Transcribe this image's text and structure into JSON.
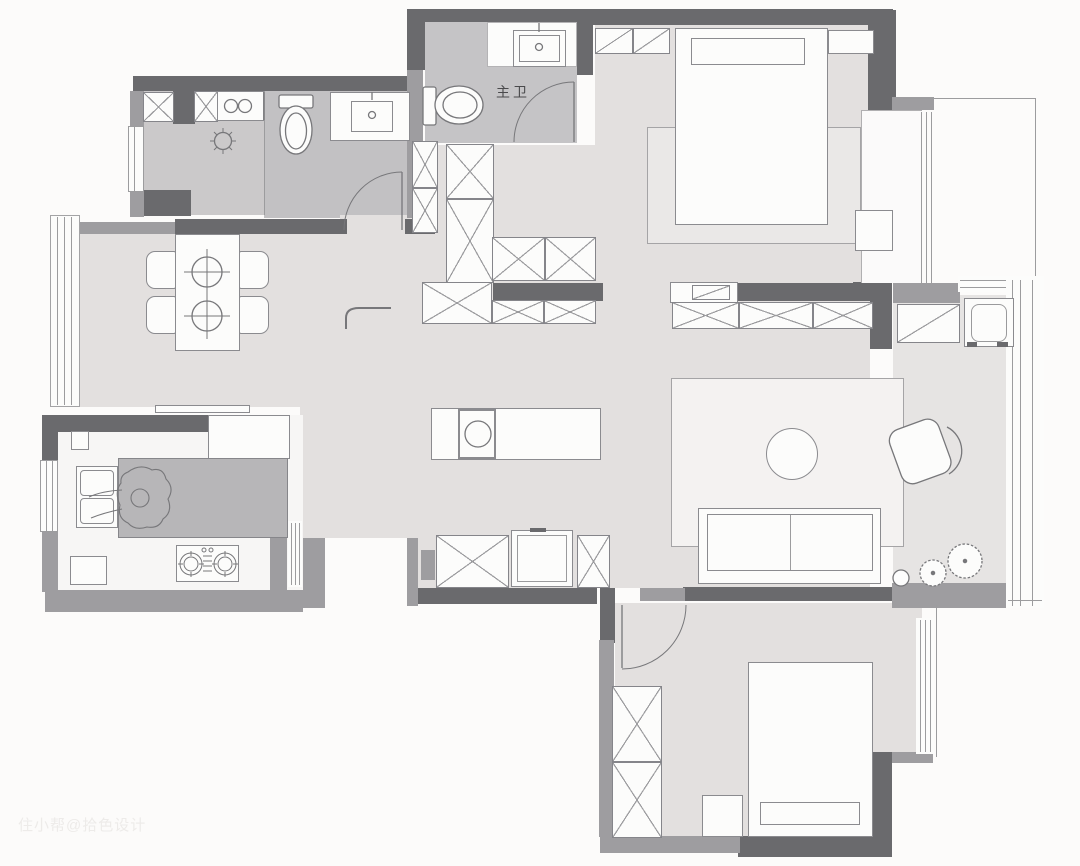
{
  "canvas": {
    "width": 1080,
    "height": 866,
    "background": "#fcfbfa"
  },
  "labels": {
    "master_bath": "主卫"
  },
  "watermark": {
    "text": "住小帮@拾色设计",
    "color": "#edebe9"
  },
  "palette": {
    "wall_dark": "#6a6a6d",
    "wall_medium": "#9e9da0",
    "floor_light": "#e3e0df",
    "floor_bath": "#c5c4c6",
    "floor_laundry": "#cbc9ca",
    "floor_kitchen": "#f7f6f5",
    "kitchen_island": "#b7b6b8",
    "furniture_fill": "#fcfcfb",
    "outline": "#8b8b8f",
    "rug_living": "#f4f2f1",
    "rug_bedroom": "#eae8e7"
  }
}
